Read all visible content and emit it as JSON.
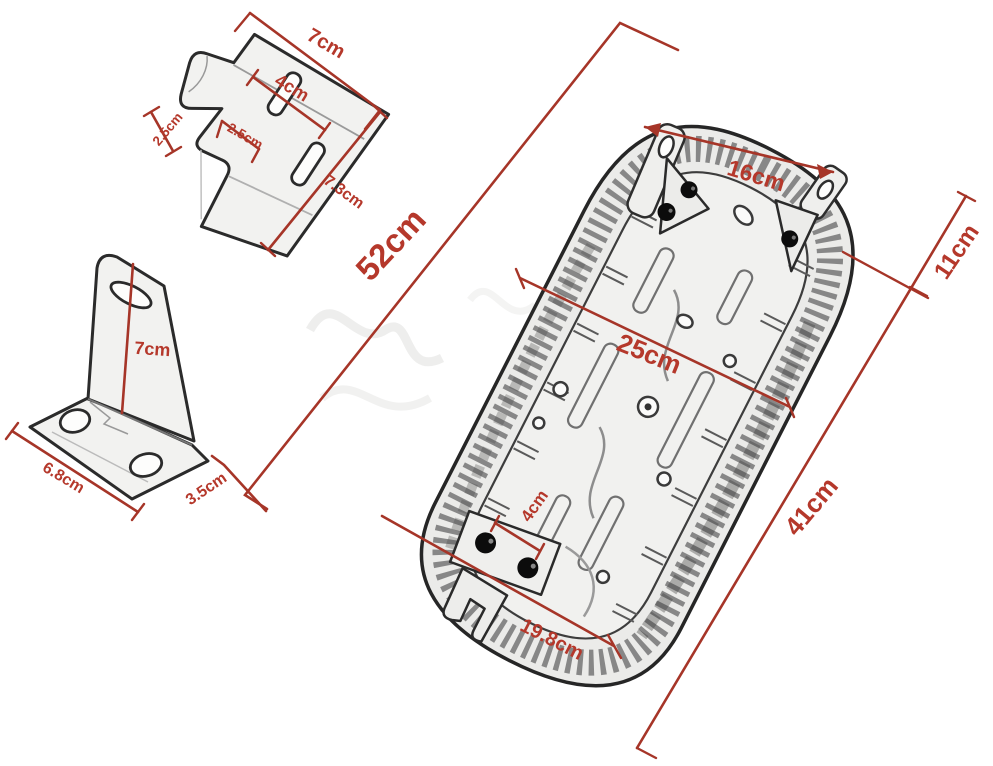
{
  "colors": {
    "dimension_line": "#a63528",
    "dimension_text": "#b5382b",
    "sketch_outline": "#2b2b2b",
    "background": "#ffffff"
  },
  "dimensions": {
    "hook_bracket": {
      "top_width": "7cm",
      "slot_spacing": "4cm",
      "hook_depth": "2.5cm",
      "notch_width": "2.5cm",
      "side_length": "7.3cm"
    },
    "angle_bracket": {
      "upright_height": "7cm",
      "base_length": "6.8cm",
      "base_width": "3.5cm"
    },
    "seat": {
      "overall_length": "52cm",
      "front_mount_spacing": "16cm",
      "front_section": "11cm",
      "width": "25cm",
      "rear_section": "41cm",
      "rear_bolt_spacing": "4cm",
      "rear_mount_width": "19.8cm"
    }
  }
}
